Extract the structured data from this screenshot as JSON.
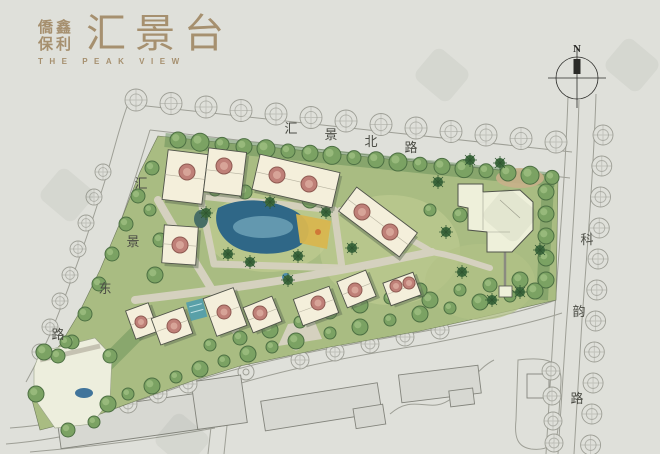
{
  "page": {
    "background": "#dfe0da"
  },
  "logo": {
    "brand_line1": "僑鑫",
    "brand_line2": "保利",
    "title": "汇景台",
    "subtitle": "THE PEAK VIEW",
    "color": "#a6906f"
  },
  "compass": {
    "label": "N"
  },
  "roads": {
    "north": {
      "name": "汇景北路"
    },
    "west": {
      "name": "汇景东路"
    },
    "east": {
      "name": "科韵路"
    }
  },
  "colors": {
    "background": "#dfe0da",
    "road_line": "#9b9c93",
    "label_text": "#4b4c45",
    "green_base": "#a9bc82",
    "green_dark": "#5d8a52",
    "tree_fill": "#7ba263",
    "tree_edge": "#4d7043",
    "tree_light": "#9cbd7f",
    "palm": "#3f6b3f",
    "street_tree": "#97988f",
    "path": "#d5d1bf",
    "building_fill": "#f4efdb",
    "building_edge": "#50534a",
    "building_shadow": "#5a6b52",
    "roof_circle": "#bf8078",
    "roof_circle_edge": "#8f5a52",
    "roof_circle_inner": "#d9a79b",
    "pool": "#2f6787",
    "pool_light": "#7fb2c4",
    "lap_pool": "#59a0a8",
    "deck": "#d8b64f",
    "deck_accent": "#d07837",
    "grey_building": "#d7d8d2",
    "grey_building_edge": "#83847c",
    "plaza": "#edeedd",
    "water_feature": "#41749b",
    "compass_ink": "#2b2b28"
  }
}
